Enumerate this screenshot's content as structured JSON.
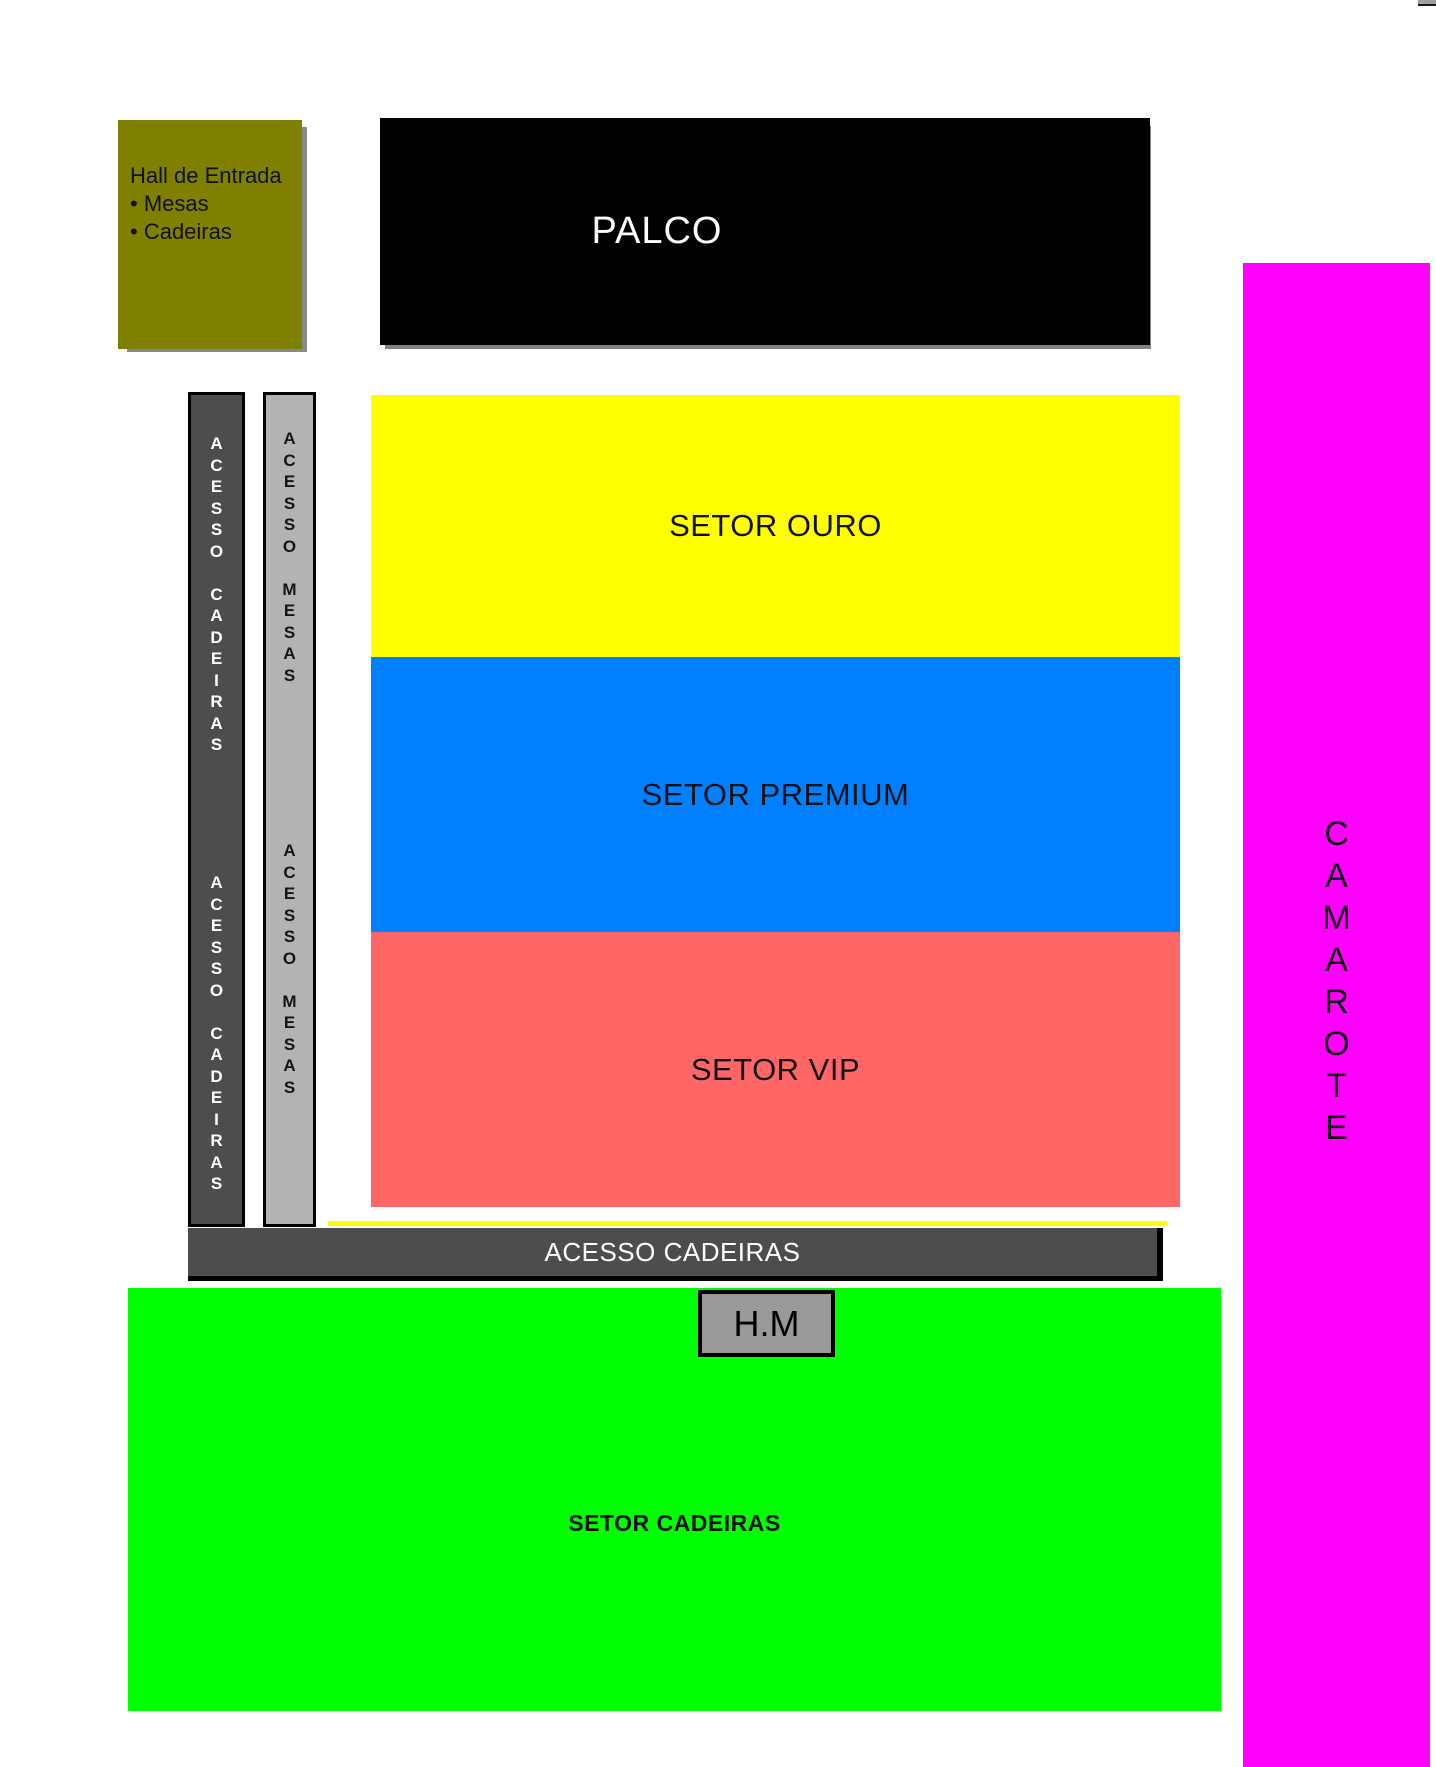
{
  "hall": {
    "text": "Hall de Entrada\n• Mesas\n• Cadeiras"
  },
  "stage": {
    "label": "PALCO"
  },
  "corridors": {
    "cadeiras_top": "A\nC\nE\nS\nS\nO\n\nC\nA\nD\nE\nI\nR\nA\nS",
    "cadeiras_bottom": "A\nC\nE\nS\nS\nO\n\nC\nA\nD\nE\nI\nR\nA\nS",
    "mesas_top": "A\nC\nE\nS\nS\nO\n\nM\nE\nS\nA\nS",
    "mesas_bottom": "A\nC\nE\nS\nS\nO\n\nM\nE\nS\nA\nS"
  },
  "sectors": {
    "ouro": {
      "label": "SETOR OURO",
      "color": "#FFFF00"
    },
    "premium": {
      "label": "SETOR PREMIUM",
      "color": "#0080FF"
    },
    "vip": {
      "label": "SETOR VIP",
      "color": "#FF6666"
    },
    "cadeiras": {
      "label": "SETOR CADEIRAS",
      "color": "#00FF00"
    }
  },
  "access_bar": {
    "label": "ACESSO CADEIRAS"
  },
  "hm_box": {
    "label": "H.M"
  },
  "camarote": {
    "letters": "C\nA\nM\nA\nR\nO\nT\nE",
    "color": "#FF00FF"
  },
  "colors": {
    "hall": "#7F7F00",
    "stage": "#000000",
    "corridor_dark": "#4D4D4D",
    "corridor_light": "#B3B3B3",
    "hm_fill": "#999999",
    "shadow": "#8A8A8A"
  }
}
